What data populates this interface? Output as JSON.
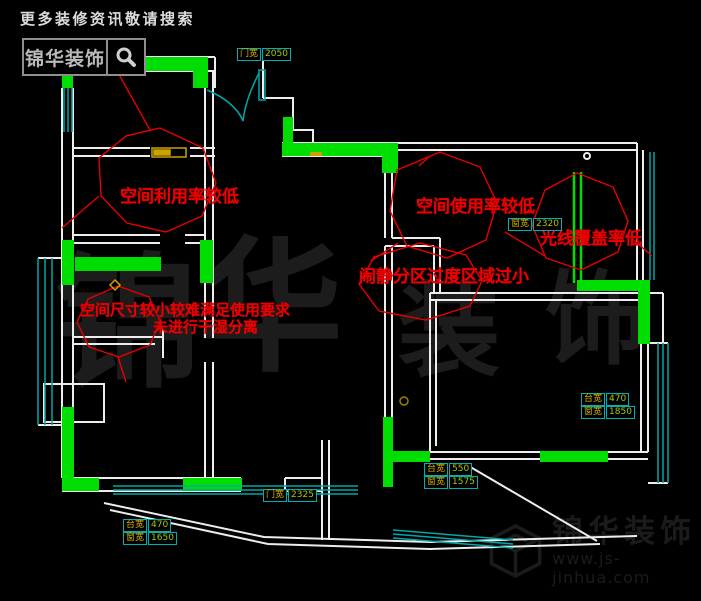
{
  "header": {
    "promo_text": "更多装修资讯敬请搜索",
    "logo_text": "锦华装饰"
  },
  "watermark": {
    "c1": "锦",
    "c2": "华",
    "c3": "装",
    "c4": "饰"
  },
  "annotations": {
    "space_utilization_low": "空间利用率较低",
    "space_usage_low": "空间使用率较低",
    "light_coverage_low": "光线覆盖率低",
    "zoning_transition_small": "闹静分区过度区域过小",
    "size_too_small": "空间尺寸较小较难满足使用要求",
    "no_dry_wet_separation": "未进行干湿分离"
  },
  "dim_labels": {
    "door_top": {
      "label": "门宽",
      "value": "2050"
    },
    "window_living": {
      "label": "窗宽",
      "value": "2320"
    },
    "sill_left": {
      "label": "台宽",
      "value": "470"
    },
    "window_left": {
      "label": "窗宽",
      "value": "1650"
    },
    "door_bottom": {
      "label": "门宽",
      "value": "2325"
    },
    "sill_mid": {
      "label": "台宽",
      "value": "550"
    },
    "window_mid": {
      "label": "窗宽",
      "value": "1575"
    },
    "sill_right": {
      "label": "台宽",
      "value": "470"
    },
    "window_right": {
      "label": "窗宽",
      "value": "1850"
    }
  },
  "footer": {
    "brand": "锦华装饰",
    "website": "www.js-jinhua.com"
  },
  "colors": {
    "highlight_green": "#00dd00",
    "wall_white": "#ededed",
    "window_cyan": "#00a8a8",
    "annotation_red": "#ee0000",
    "label_yellow": "#d8b400",
    "background": "#000000"
  }
}
